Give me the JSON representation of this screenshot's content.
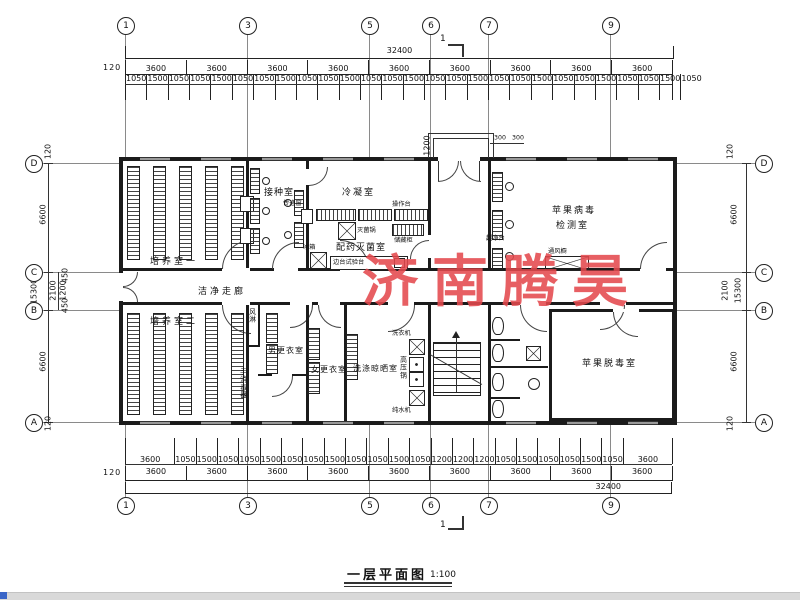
{
  "title": {
    "name": "一层平面图",
    "scale": "1:100"
  },
  "watermark": {
    "text": "济南腾昊",
    "color": "#e4494e"
  },
  "section": {
    "label": "1"
  },
  "grid": {
    "top": [
      "1",
      "3",
      "5",
      "6",
      "7",
      "9"
    ],
    "bottom": [
      "1",
      "3",
      "5",
      "6",
      "7",
      "9"
    ],
    "left": [
      "D",
      "C",
      "B",
      "A"
    ],
    "right": [
      "D",
      "C",
      "B",
      "A"
    ]
  },
  "dimensions": {
    "top": {
      "overall": "32400",
      "edge": "120",
      "bays": [
        "3600",
        "3600",
        "3600",
        "3600",
        "3600",
        "3600",
        "3600",
        "3600",
        "3600"
      ],
      "detail": [
        "1050",
        "1500",
        "1050",
        "1050",
        "1500",
        "1050",
        "1050",
        "1500",
        "1050",
        "1050",
        "1500",
        "1050",
        "1050",
        "1500",
        "1050",
        "1050",
        "1500",
        "1050",
        "1050",
        "1500",
        "1050",
        "1050",
        "1500",
        "1050",
        "1050",
        "1500",
        "1050"
      ]
    },
    "bottom": {
      "overall": "32400",
      "edge": "120",
      "bays": [
        "3600",
        "3600",
        "3600",
        "3600",
        "3600",
        "3600",
        "3600",
        "3600",
        "3600"
      ],
      "detail": [
        "3600",
        "1050",
        "1500",
        "1050",
        "1050",
        "1500",
        "1050",
        "1050",
        "1500",
        "1050",
        "1050",
        "1500",
        "1050",
        "1200",
        "1200",
        "1200",
        "1050",
        "1500",
        "1050",
        "1050",
        "1500",
        "1050",
        "3600"
      ]
    },
    "left": {
      "overall": "15300",
      "edge_top": "120",
      "seg_top": "6600",
      "seg_mid": "2100",
      "sub_a": "450",
      "sub_b": "1200",
      "sub_c": "450",
      "seg_bottom": "6600",
      "edge_bottom": "120"
    },
    "right": {
      "overall": "15300",
      "edge_top": "120",
      "seg_top": "6600",
      "seg_mid": "2100",
      "seg_bottom": "6600",
      "edge_bottom": "120"
    },
    "entrance": {
      "depth": "1200",
      "left": "300",
      "right": "300"
    }
  },
  "rooms": {
    "culture1": "培养室一",
    "inoculation": "接种室",
    "condensation": "冷凝室",
    "prep": "配药灭菌室",
    "virus_line1": "苹果病毒",
    "virus_line2": "检测室",
    "corridor": "洁净走廊",
    "culture2": "培养室二",
    "men_changing": "男更衣室",
    "women_changing": "女更衣室",
    "washing": "洗涤晾晒室",
    "detox": "苹果脱毒室"
  },
  "equipment": {
    "pass_window": "传递窗",
    "worktop": "操作台",
    "sterilizer": "灭菌锅",
    "cabinet": "储藏柜",
    "side_bench": "边台试验台",
    "fridge": "冰箱",
    "clean_bench": "超净台",
    "fume_hood": "通风橱",
    "air_shower": "风淋",
    "hand_sanitizer": "手消毒器",
    "washer": "洗衣机",
    "autoclave": "高压锅",
    "water_purifier": "纯水机"
  }
}
